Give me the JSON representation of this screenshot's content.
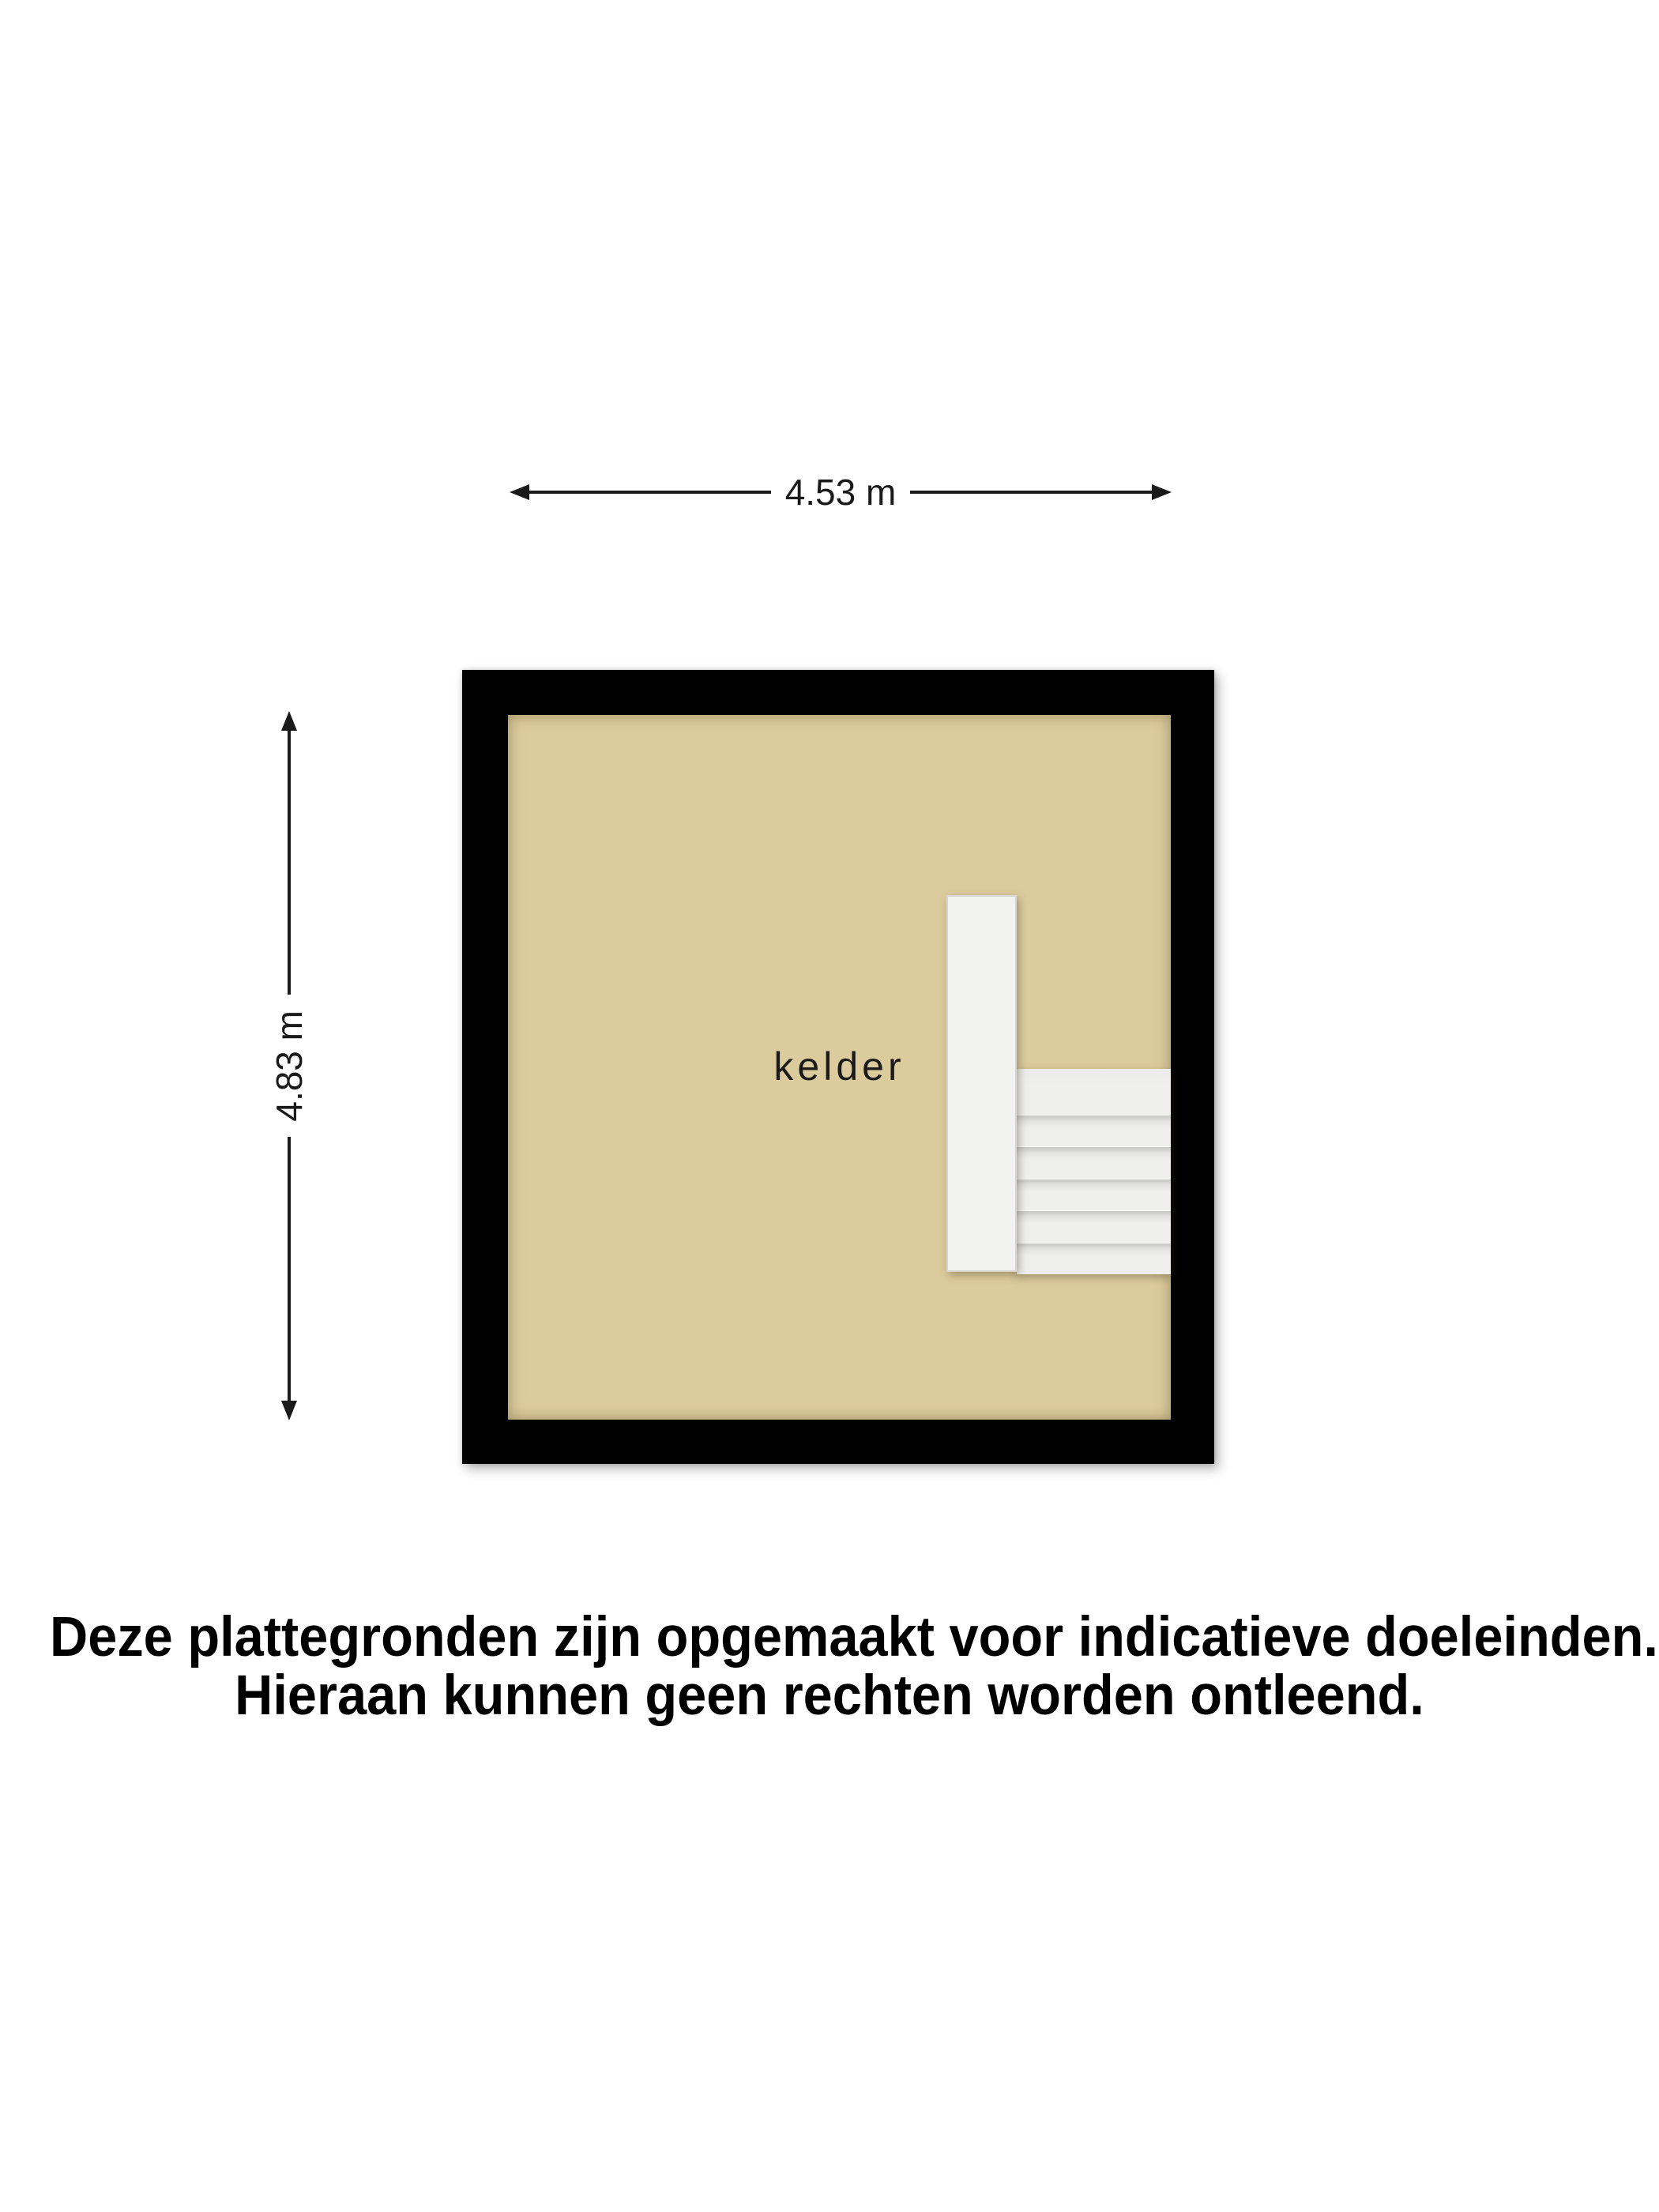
{
  "dimensions": {
    "width": {
      "label": "4.53 m"
    },
    "height": {
      "label": "4.83 m"
    }
  },
  "room": {
    "label": "kelder"
  },
  "stairs": {
    "tread_count": 6
  },
  "disclaimer": {
    "line1": "Deze plattegronden zijn opgemaakt voor indicatieve doeleinden.",
    "line2": "Hieraan kunnen geen rechten worden ontleend."
  },
  "colors": {
    "page_bg": "#ffffff",
    "floor": "#dccb9d",
    "wall": "#000000",
    "stair_surface": "#efefee",
    "partition_surface": "#f2f2f1",
    "dimension_line": "#1a1a1a",
    "text": "#000000"
  }
}
